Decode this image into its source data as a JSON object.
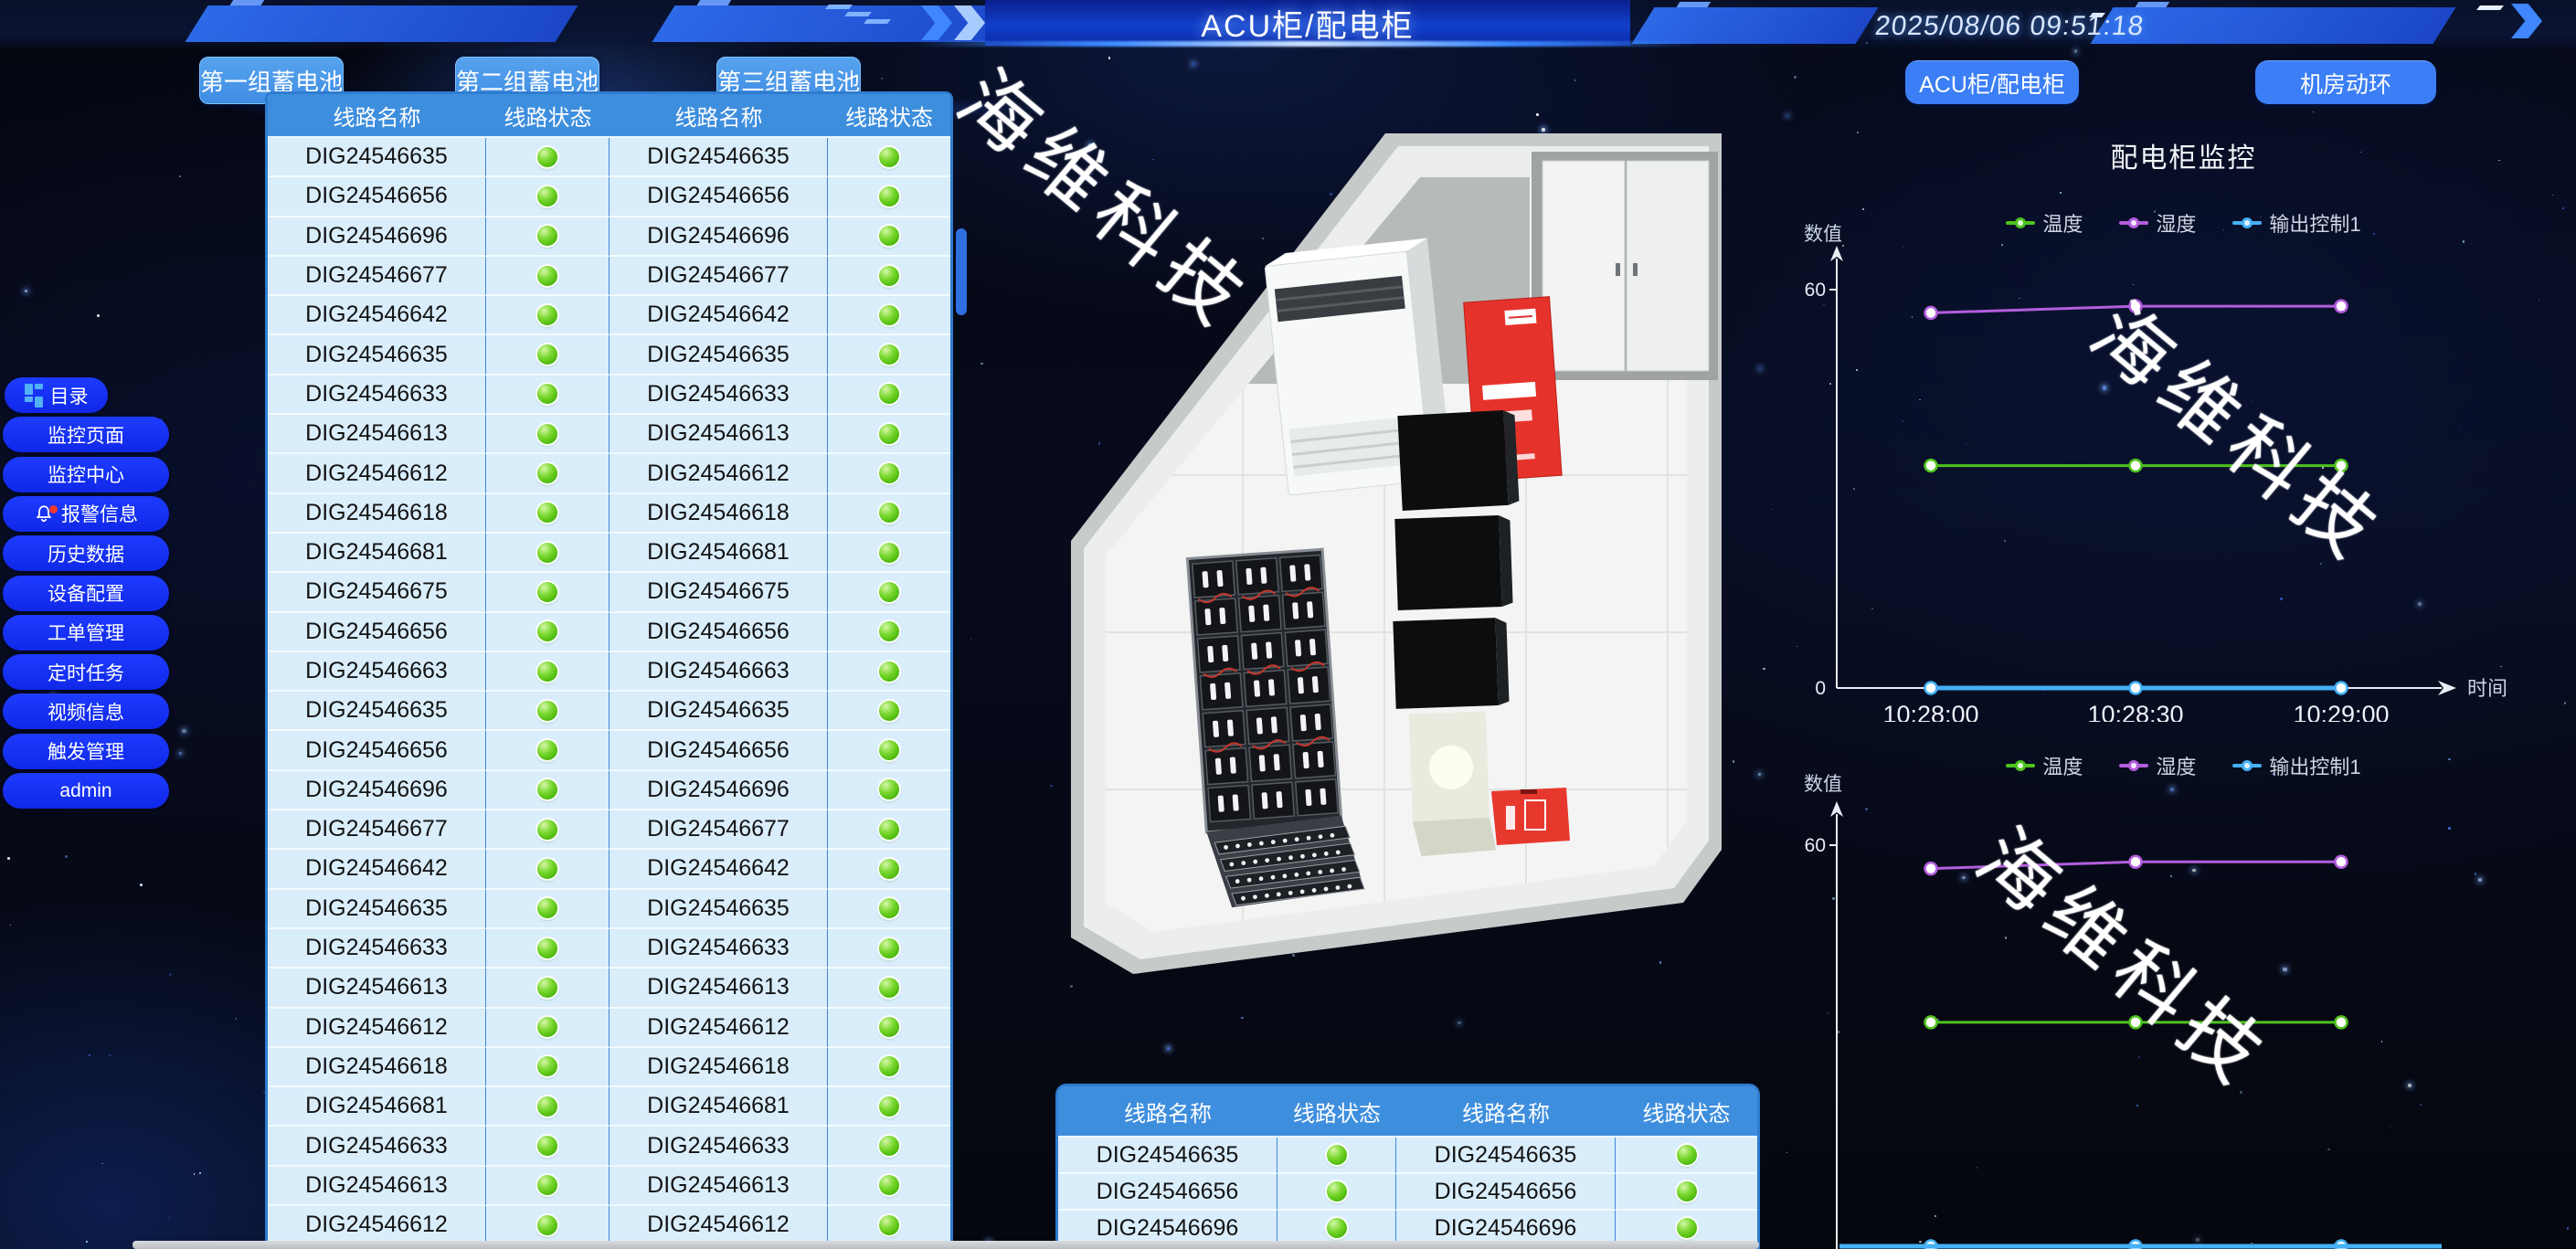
{
  "header": {
    "title": "ACU柜/配电柜",
    "datetime": "2025/08/06 09:51:18",
    "battery_tabs": [
      "第一组蓄电池",
      "第二组蓄电池",
      "第三组蓄电池"
    ],
    "nav_tabs": [
      "ACU柜/配电柜",
      "机房动环"
    ]
  },
  "sidebar": {
    "items": [
      {
        "label": "目录",
        "icon": "menu-grid-icon"
      },
      {
        "label": "监控页面"
      },
      {
        "label": "监控中心"
      },
      {
        "label": "报警信息",
        "icon": "alarm-bell-icon",
        "alert_dot": true
      },
      {
        "label": "历史数据"
      },
      {
        "label": "设备配置"
      },
      {
        "label": "工单管理"
      },
      {
        "label": "定时任务"
      },
      {
        "label": "视频信息"
      },
      {
        "label": "触发管理"
      },
      {
        "label": "admin"
      }
    ]
  },
  "tables": {
    "columns": [
      "线路名称",
      "线路状态",
      "线路名称",
      "线路状态"
    ],
    "status_ok_color": "#5bc617",
    "main_rows": [
      [
        "DIG24546635",
        "DIG24546635"
      ],
      [
        "DIG24546656",
        "DIG24546656"
      ],
      [
        "DIG24546696",
        "DIG24546696"
      ],
      [
        "DIG24546677",
        "DIG24546677"
      ],
      [
        "DIG24546642",
        "DIG24546642"
      ],
      [
        "DIG24546635",
        "DIG24546635"
      ],
      [
        "DIG24546633",
        "DIG24546633"
      ],
      [
        "DIG24546613",
        "DIG24546613"
      ],
      [
        "DIG24546612",
        "DIG24546612"
      ],
      [
        "DIG24546618",
        "DIG24546618"
      ],
      [
        "DIG24546681",
        "DIG24546681"
      ],
      [
        "DIG24546675",
        "DIG24546675"
      ],
      [
        "DIG24546656",
        "DIG24546656"
      ],
      [
        "DIG24546663",
        "DIG24546663"
      ],
      [
        "DIG24546635",
        "DIG24546635"
      ],
      [
        "DIG24546656",
        "DIG24546656"
      ],
      [
        "DIG24546696",
        "DIG24546696"
      ],
      [
        "DIG24546677",
        "DIG24546677"
      ],
      [
        "DIG24546642",
        "DIG24546642"
      ],
      [
        "DIG24546635",
        "DIG24546635"
      ],
      [
        "DIG24546633",
        "DIG24546633"
      ],
      [
        "DIG24546613",
        "DIG24546613"
      ],
      [
        "DIG24546612",
        "DIG24546612"
      ],
      [
        "DIG24546618",
        "DIG24546618"
      ],
      [
        "DIG24546681",
        "DIG24546681"
      ],
      [
        "DIG24546633",
        "DIG24546633"
      ],
      [
        "DIG24546613",
        "DIG24546613"
      ],
      [
        "DIG24546612",
        "DIG24546612"
      ]
    ],
    "bottom_rows": [
      [
        "DIG24546635",
        "DIG24546635"
      ],
      [
        "DIG24546656",
        "DIG24546656"
      ],
      [
        "DIG24546696",
        "DIG24546696"
      ],
      [
        "",
        ""
      ]
    ]
  },
  "chart_data": [
    {
      "type": "line",
      "title": "配电柜监控",
      "ylabel": "数值",
      "xlabel": "时间",
      "x": [
        "10:28:00",
        "10:28:30",
        "10:29:00"
      ],
      "ylim": [
        0,
        60
      ],
      "yticks": [
        0,
        60
      ],
      "legend_position": "top",
      "grid": false,
      "series": [
        {
          "name": "温度",
          "color": "#4ec41f",
          "values": [
            33.5,
            33.5,
            33.5
          ]
        },
        {
          "name": "湿度",
          "color": "#b35ede",
          "values": [
            56.5,
            57.5,
            57.5
          ]
        },
        {
          "name": "输出控制1",
          "color": "#45b0f6",
          "values": [
            0,
            0,
            0
          ]
        }
      ]
    },
    {
      "type": "line",
      "title": "",
      "ylabel": "数值",
      "xlabel": "",
      "x": [
        "",
        "",
        ""
      ],
      "ylim": [
        0,
        60
      ],
      "yticks": [
        60
      ],
      "legend_position": "top",
      "grid": false,
      "series": [
        {
          "name": "温度",
          "color": "#4ec41f",
          "values": [
            33.5,
            33.5,
            33.5
          ]
        },
        {
          "name": "湿度",
          "color": "#b35ede",
          "values": [
            56.5,
            57.5,
            57.5
          ]
        },
        {
          "name": "输出控制1",
          "color": "#45b0f6",
          "values": [
            0,
            0,
            0
          ]
        }
      ]
    }
  ],
  "watermark": {
    "text": "海维科技"
  }
}
